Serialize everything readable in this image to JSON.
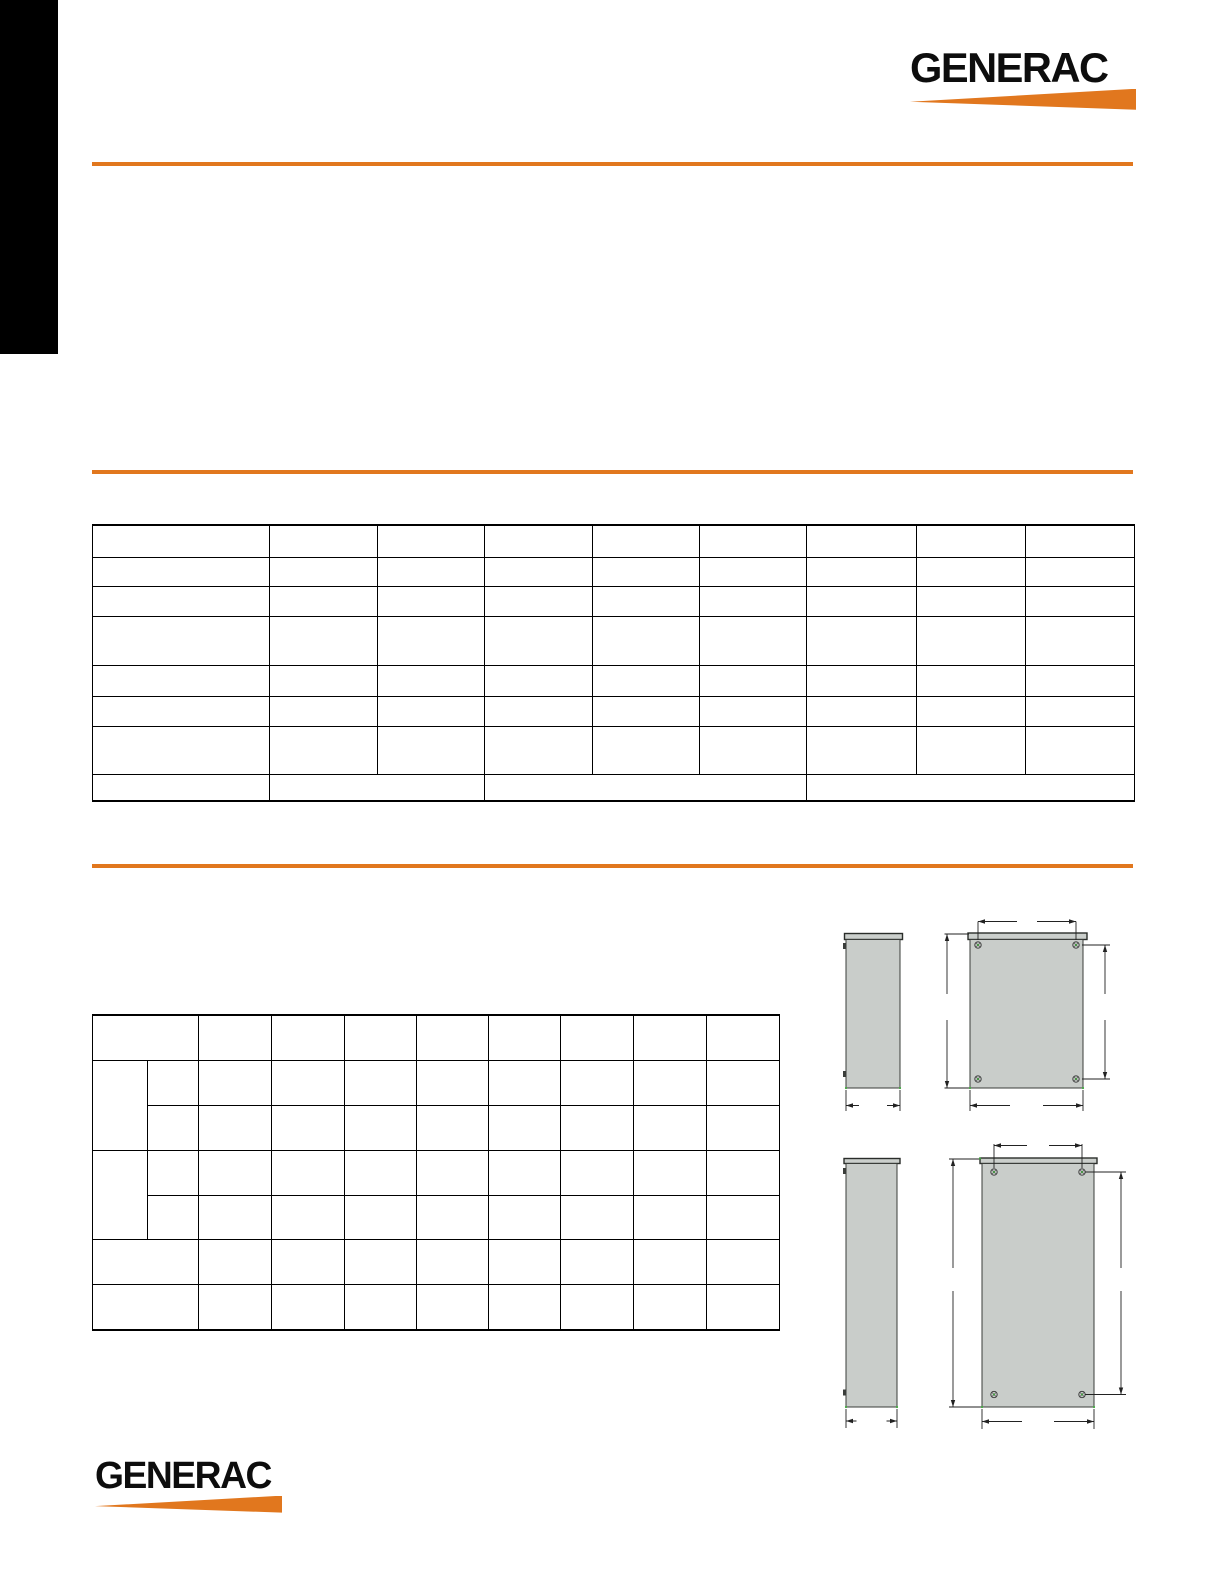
{
  "brand": {
    "logo_text": "GENERAC",
    "orange": "#E1771E",
    "black": "#000000",
    "drawing_fill_gray": "#C9CDCA",
    "drawing_line": "#2B2B2B",
    "green_tick": "#3FA33C"
  },
  "header": {
    "logo_text": "GENERAC"
  },
  "footer": {
    "logo_text": "GENERAC"
  },
  "sections": {
    "note": "All body text of this spec sheet is not rendered in the pixels; tables and drawings appear with empty cells."
  },
  "tables": [
    {
      "id": "spec-table",
      "width": 1042,
      "colWidths": [
        177,
        108,
        107,
        108,
        107,
        107,
        110,
        109,
        109
      ],
      "rowHeights": [
        32,
        29,
        30,
        49,
        31,
        30,
        48,
        27
      ],
      "rows": [
        [
          {},
          {},
          {},
          {},
          {},
          {},
          {},
          {},
          {}
        ],
        [
          {},
          {},
          {},
          {},
          {},
          {},
          {},
          {},
          {}
        ],
        [
          {},
          {},
          {},
          {},
          {},
          {},
          {},
          {},
          {}
        ],
        [
          {},
          {},
          {},
          {},
          {},
          {},
          {},
          {},
          {}
        ],
        [
          {},
          {},
          {},
          {},
          {},
          {},
          {},
          {},
          {}
        ],
        [
          {},
          {},
          {},
          {},
          {},
          {},
          {},
          {},
          {}
        ],
        [
          {},
          {},
          {},
          {},
          {},
          {},
          {},
          {},
          {}
        ],
        [
          {},
          {
            "c": 2
          },
          {
            "c": 3
          },
          {
            "c": 3
          }
        ]
      ]
    },
    {
      "id": "dimensions-table",
      "width": 687,
      "colWidths": [
        55,
        51,
        73,
        73,
        72,
        72,
        72,
        73,
        73,
        73
      ],
      "rowHeights": [
        45,
        45,
        45,
        45,
        44,
        45,
        46
      ],
      "rows": [
        [
          {
            "c": 2
          },
          {},
          {},
          {},
          {},
          {},
          {},
          {},
          {}
        ],
        [
          {
            "r": 2
          },
          {},
          {},
          {},
          {},
          {},
          {},
          {},
          {},
          {}
        ],
        [
          {},
          {},
          {},
          {},
          {},
          {},
          {},
          {},
          {}
        ],
        [
          {
            "r": 2
          },
          {},
          {},
          {},
          {},
          {},
          {},
          {},
          {},
          {}
        ],
        [
          {},
          {},
          {},
          {},
          {},
          {},
          {},
          {},
          {}
        ],
        [
          {
            "c": 2
          },
          {},
          {},
          {},
          {},
          {},
          {},
          {},
          {}
        ],
        [
          {
            "c": 2
          },
          {},
          {},
          {},
          {},
          {},
          {},
          {},
          {}
        ]
      ]
    }
  ],
  "drawings": [
    {
      "id": "enclosure-drawing-top",
      "views": [
        "side-view",
        "front-view"
      ],
      "screws": 4
    },
    {
      "id": "enclosure-drawing-bottom",
      "views": [
        "side-view",
        "front-view"
      ],
      "screws": 4
    }
  ]
}
